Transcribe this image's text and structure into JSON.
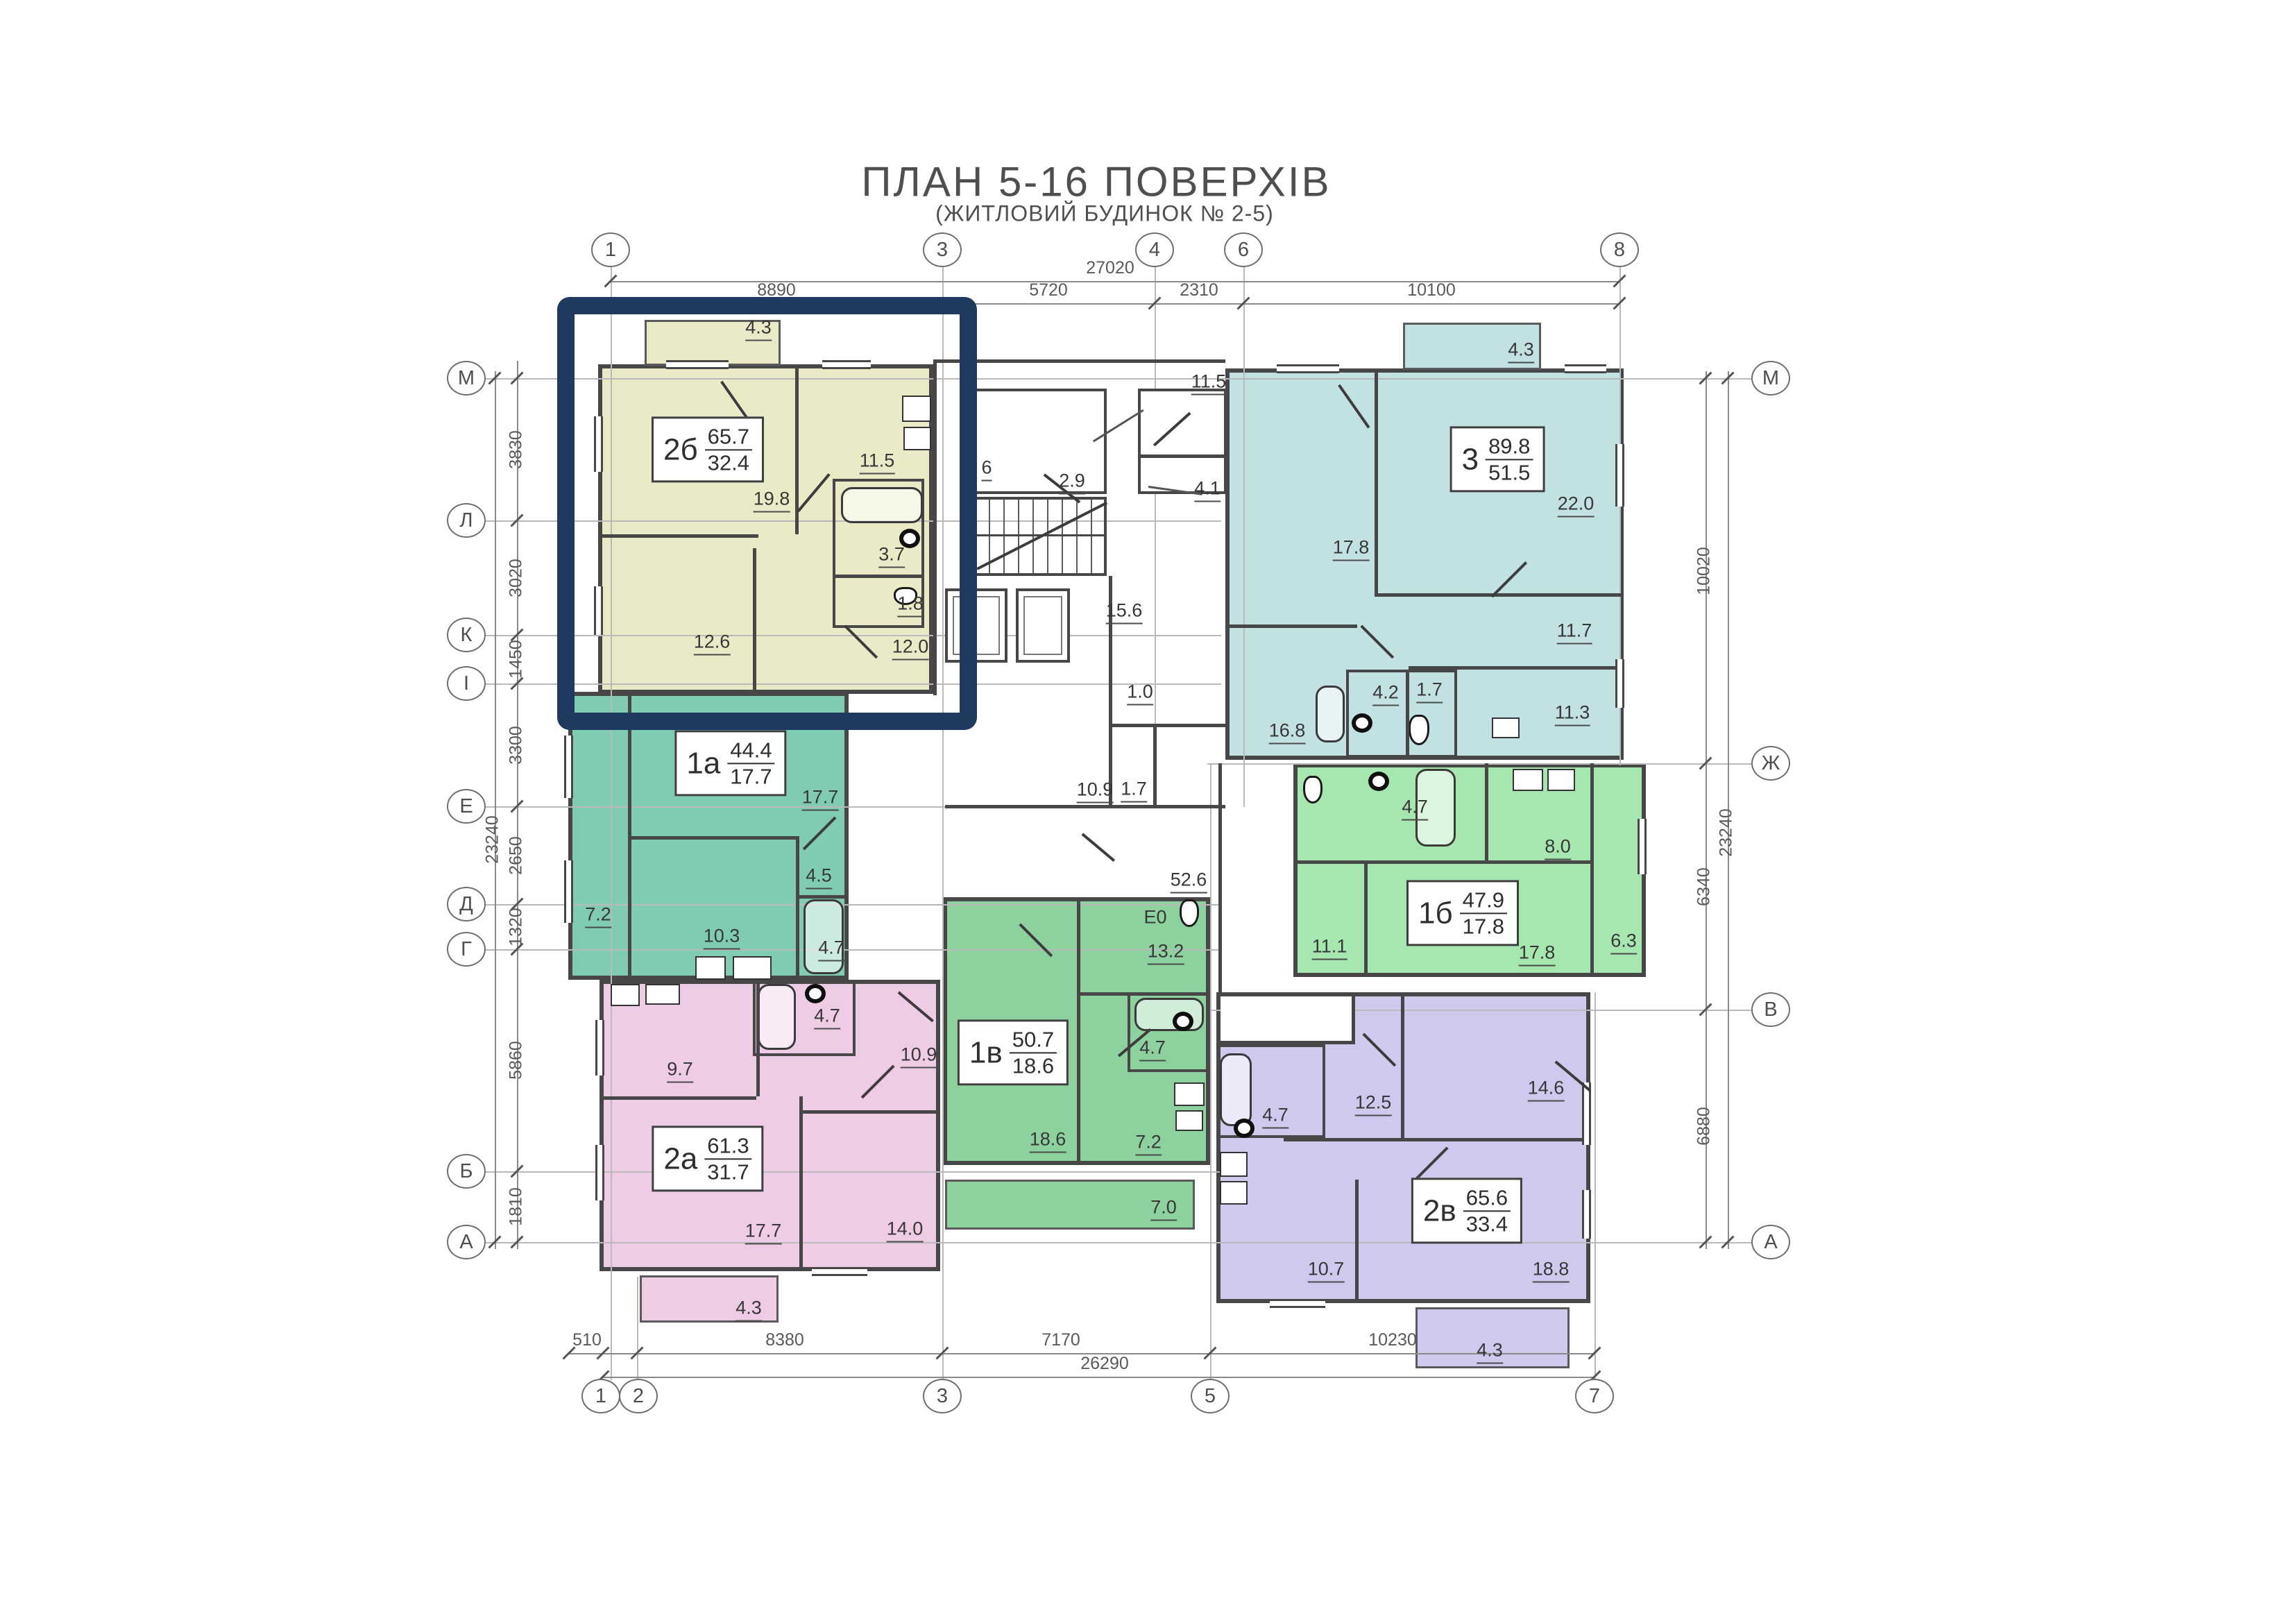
{
  "title": "ПЛАН 5-16 ПОВЕРХІВ",
  "subtitle": "(ЖИТЛОВИЙ БУДИНОК № 2-5)",
  "axes": {
    "top": [
      "1",
      "3",
      "4",
      "6",
      "8"
    ],
    "bottom": [
      "1",
      "2",
      "3",
      "5",
      "7"
    ],
    "left": [
      "М",
      "Л",
      "К",
      "І",
      "Е",
      "Д",
      "Г",
      "Б",
      "А"
    ],
    "right": [
      "М",
      "Ж",
      "В",
      "А"
    ]
  },
  "dimensions": {
    "top": {
      "overall": "27020",
      "segments": [
        "8890",
        "5720",
        "2310",
        "10100"
      ]
    },
    "bottom": {
      "overall": "26290",
      "segments": [
        "510",
        "8380",
        "7170",
        "10230"
      ]
    },
    "left": {
      "overall": "23240",
      "segments": [
        "3830",
        "3020",
        "1450",
        "3300",
        "2650",
        "1320",
        "5860",
        "1810"
      ]
    },
    "right": {
      "overall": "23240",
      "segments": [
        "10020",
        "6340",
        "6880"
      ]
    }
  },
  "colors": {
    "highlight": "#1e3a5e",
    "wall": "#474747",
    "apt_2b": "#eaeac6",
    "apt_1a": "#7fccb2",
    "apt_3": "#c2e1e3",
    "apt_1b": "#a5e7ae",
    "apt_2a": "#eecce5",
    "apt_1v": "#8dd19e",
    "apt_2v": "#cfc9ed"
  },
  "apartments": [
    {
      "code": "2б",
      "total": "65.7",
      "living": "32.4",
      "rooms": [
        "4.3",
        "11.5",
        "19.8",
        "3.7",
        "1.8",
        "12.6",
        "12.0"
      ]
    },
    {
      "code": "1а",
      "total": "44.4",
      "living": "17.7",
      "rooms": [
        "17.7",
        "4.5",
        "7.2",
        "10.3",
        "4.7"
      ]
    },
    {
      "code": "3",
      "total": "89.8",
      "living": "51.5",
      "rooms": [
        "4.3",
        "22.0",
        "17.8",
        "11.7",
        "11.3",
        "16.8",
        "4.2",
        "1.7"
      ]
    },
    {
      "code": "1б",
      "total": "47.9",
      "living": "17.8",
      "rooms": [
        "4.7",
        "8.0",
        "11.1",
        "17.8",
        "6.3"
      ]
    },
    {
      "code": "2а",
      "total": "61.3",
      "living": "31.7",
      "rooms": [
        "9.7",
        "4.7",
        "10.9",
        "17.7",
        "14.0",
        "4.3"
      ]
    },
    {
      "code": "1в",
      "total": "50.7",
      "living": "18.6",
      "rooms": [
        "13.2",
        "Е0",
        "4.7",
        "18.6",
        "7.2",
        "7.0"
      ]
    },
    {
      "code": "2в",
      "total": "65.6",
      "living": "33.4",
      "rooms": [
        "12.5",
        "14.6",
        "4.7",
        "10.7",
        "18.8",
        "4.3"
      ]
    }
  ],
  "common": {
    "rooms": [
      "2.9",
      "11.5",
      "4.1",
      "15.6",
      "1.0",
      "10.9",
      "1.7",
      "6",
      "52.6"
    ]
  }
}
